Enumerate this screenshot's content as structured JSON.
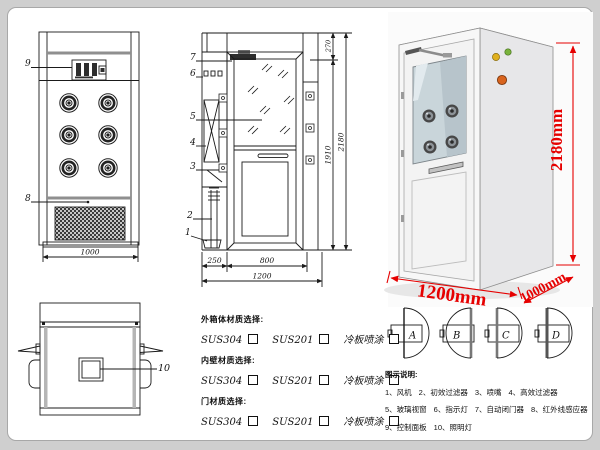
{
  "front_view": {
    "callout_9": "9",
    "callout_8": "8",
    "dim_width": "1000"
  },
  "side_view": {
    "callouts": [
      "7",
      "6",
      "5",
      "4",
      "3",
      "2",
      "1"
    ],
    "dim_top_section": "270",
    "dim_inner_height": "1910",
    "dim_total_height": "2180",
    "dim_left_depth": "250",
    "dim_door_width": "800",
    "dim_total_width": "1200"
  },
  "top_view": {
    "callout_10": "10"
  },
  "render_3d": {
    "dim_height": "2180mm",
    "dim_width": "1200mm",
    "dim_depth": "1000mm"
  },
  "materials": {
    "groups": [
      {
        "title": "外箱体材质选择:",
        "options": [
          "SUS304",
          "SUS201",
          "冷板喷涂"
        ]
      },
      {
        "title": "内壁材质选择:",
        "options": [
          "SUS304",
          "SUS201",
          "冷板喷涂"
        ]
      },
      {
        "title": "门材质选择:",
        "options": [
          "SUS304",
          "SUS201",
          "冷板喷涂"
        ]
      }
    ]
  },
  "door_options": {
    "labels": [
      "A",
      "B",
      "C",
      "D"
    ]
  },
  "legend": {
    "title": "图示说明:",
    "rows": [
      [
        "1、风机",
        "2、初效过滤器",
        "3、喷嘴",
        "4、高效过滤器"
      ],
      [
        "5、玻璃视窗",
        "6、指示灯",
        "7、自动闭门器",
        "8、红外线感应器"
      ],
      [
        "9、控制面板",
        "10、照明灯"
      ]
    ]
  },
  "colors": {
    "dimension_red": "#e60000",
    "line": "#1a1a1a"
  }
}
